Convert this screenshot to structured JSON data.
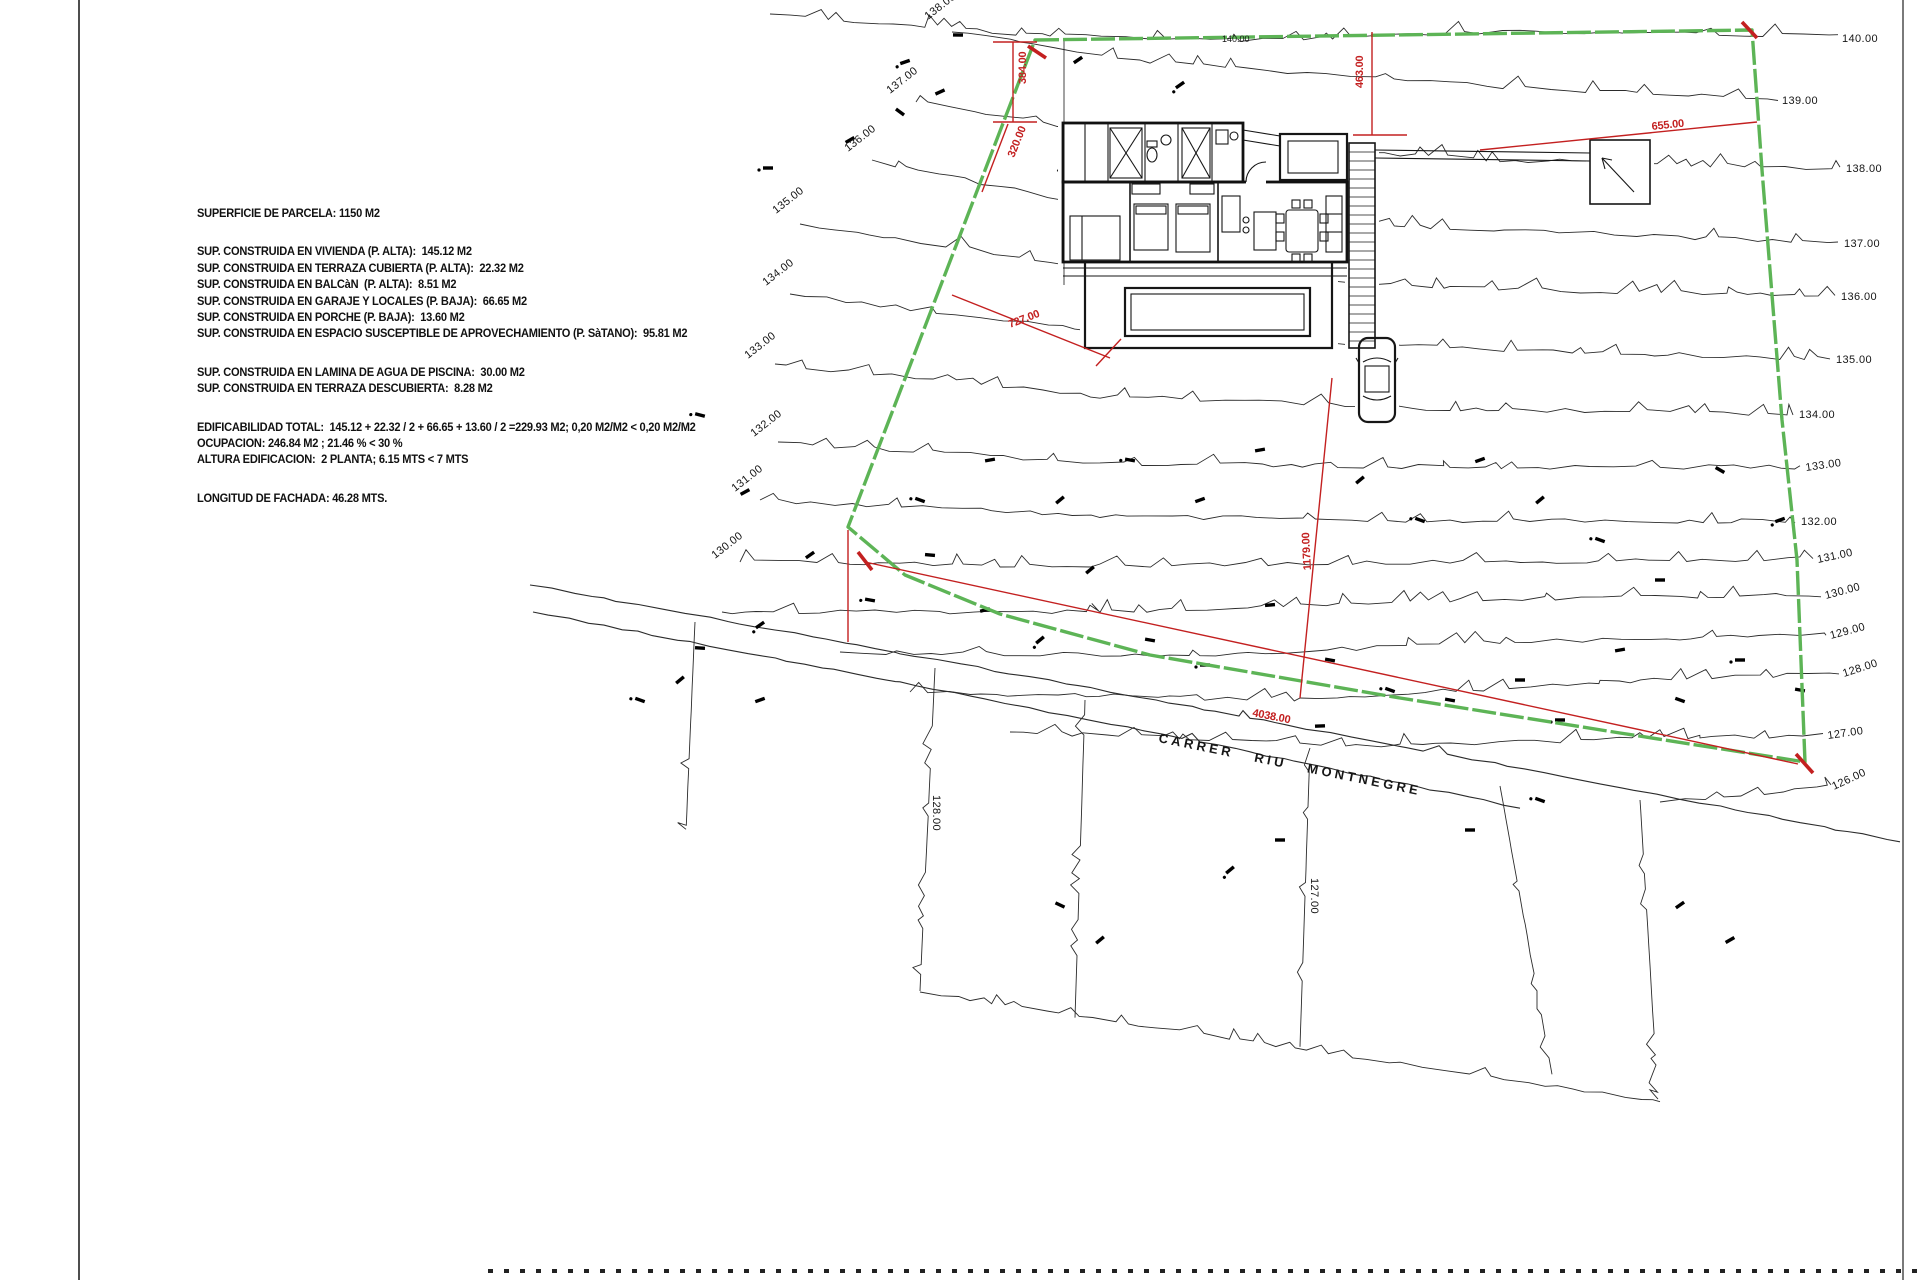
{
  "sheet": {
    "width": 1920,
    "height": 1280
  },
  "colors": {
    "line": "#2b2b2b",
    "boundary_green": "#5db456",
    "dim_red": "#c32020",
    "text": "#111111"
  },
  "info_panel": {
    "x": 197,
    "y": 206,
    "lines": [
      "SUPERFICIE DE PARCELA: 1150 M2",
      "",
      "",
      "SUP. CONSTRUIDA EN VIVIENDA (P. ALTA):  145.12 M2",
      "SUP. CONSTRUIDA EN TERRAZA CUBIERTA (P. ALTA):  22.32 M2",
      "SUP. CONSTRUIDA EN BALCàN  (P. ALTA):  8.51 M2",
      "SUP. CONSTRUIDA EN GARAJE Y LOCALES (P. BAJA):  66.65 M2",
      "SUP. CONSTRUIDA EN PORCHE (P. BAJA):  13.60 M2",
      "SUP. CONSTRUIDA EN ESPACIO SUSCEPTIBLE DE APROVECHAMIENTO (P. SàTANO):  95.81 M2",
      "",
      "",
      "SUP. CONSTRUIDA EN LAMINA DE AGUA DE PISCINA:  30.00 M2",
      "SUP. CONSTRUIDA EN TERRAZA DESCUBIERTA:  8.28 M2",
      "",
      "",
      "EDIFICABILIDAD TOTAL:  145.12 + 22.32 / 2 + 66.65 + 13.60 / 2 =229.93 M2; 0,20 M2/M2 < 0,20 M2/M2",
      "OCUPACION: 246.84 M2 ; 21.46 % < 30 %",
      "ALTURA EDIFICACION:  2 PLANTA; 6.15 MTS < 7 MTS",
      "",
      "",
      "LONGITUD DE FACHADA: 46.28 MTS."
    ]
  },
  "street": {
    "name": "CARRER  RIU  MONTNEGRE",
    "x": 1158,
    "y": 742,
    "rotate": 11.5
  },
  "site": {
    "boundary": [
      [
        1035,
        40
      ],
      [
        1752,
        30
      ],
      [
        1762,
        170
      ],
      [
        1782,
        420
      ],
      [
        1797,
        560
      ],
      [
        1805,
        762
      ],
      [
        1620,
        733
      ],
      [
        1400,
        698
      ],
      [
        1150,
        655
      ],
      [
        1000,
        614
      ],
      [
        905,
        575
      ],
      [
        848,
        527
      ]
    ],
    "contours": [
      {
        "e": 140,
        "pts": [
          [
            770,
            14
          ],
          [
            1050,
            36
          ],
          [
            1240,
            40
          ],
          [
            1520,
            32
          ],
          [
            1838,
            36
          ]
        ]
      },
      {
        "e": 139,
        "pts": [
          [
            952,
            32
          ],
          [
            1150,
            62
          ],
          [
            1450,
            84
          ],
          [
            1778,
            100
          ]
        ]
      },
      {
        "e": 138,
        "pts": [
          [
            916,
            102
          ],
          [
            1150,
            140
          ],
          [
            1500,
            160
          ],
          [
            1840,
            168
          ]
        ]
      },
      {
        "e": 137,
        "pts": [
          [
            872,
            160
          ],
          [
            1100,
            208
          ],
          [
            1450,
            228
          ],
          [
            1838,
            243
          ]
        ]
      },
      {
        "e": 136,
        "pts": [
          [
            800,
            224
          ],
          [
            1100,
            268
          ],
          [
            1450,
            288
          ],
          [
            1835,
            296
          ]
        ]
      },
      {
        "e": 135,
        "pts": [
          [
            790,
            294
          ],
          [
            1100,
            332
          ],
          [
            1450,
            348
          ],
          [
            1830,
            359
          ]
        ]
      },
      {
        "e": 134,
        "pts": [
          [
            775,
            364
          ],
          [
            1100,
            396
          ],
          [
            1450,
            409
          ],
          [
            1793,
            414
          ]
        ]
      },
      {
        "e": 133,
        "pts": [
          [
            778,
            442
          ],
          [
            1100,
            463
          ],
          [
            1450,
            467
          ],
          [
            1800,
            467
          ]
        ]
      },
      {
        "e": 132,
        "pts": [
          [
            760,
            500
          ],
          [
            1100,
            516
          ],
          [
            1450,
            521
          ],
          [
            1795,
            521
          ]
        ]
      },
      {
        "e": 131,
        "pts": [
          [
            740,
            562
          ],
          [
            1100,
            566
          ],
          [
            1450,
            562
          ],
          [
            1813,
            559
          ]
        ]
      },
      {
        "e": 130,
        "pts": [
          [
            722,
            612
          ],
          [
            1100,
            612
          ],
          [
            1450,
            600
          ],
          [
            1821,
            595
          ]
        ]
      },
      {
        "e": 129,
        "pts": [
          [
            840,
            652
          ],
          [
            1200,
            656
          ],
          [
            1500,
            642
          ],
          [
            1826,
            635
          ]
        ]
      },
      {
        "e": 128,
        "pts": [
          [
            910,
            692
          ],
          [
            1300,
            700
          ],
          [
            1600,
            682
          ],
          [
            1839,
            673
          ]
        ]
      },
      {
        "e": 127,
        "pts": [
          [
            1010,
            732
          ],
          [
            1400,
            746
          ],
          [
            1700,
            737
          ],
          [
            1823,
            735
          ]
        ]
      },
      {
        "e": 126,
        "pts": [
          [
            1660,
            802
          ],
          [
            1831,
            786
          ]
        ]
      }
    ],
    "contour_labels": {
      "right": [
        {
          "t": "140.00",
          "x": 1842,
          "y": 42,
          "r": 0
        },
        {
          "t": "139.00",
          "x": 1782,
          "y": 104,
          "r": 0
        },
        {
          "t": "138.00",
          "x": 1846,
          "y": 172,
          "r": 0
        },
        {
          "t": "137.00",
          "x": 1844,
          "y": 247,
          "r": 0
        },
        {
          "t": "136.00",
          "x": 1841,
          "y": 300,
          "r": 0
        },
        {
          "t": "135.00",
          "x": 1836,
          "y": 363,
          "r": 0
        },
        {
          "t": "134.00",
          "x": 1799,
          "y": 418,
          "r": 0
        },
        {
          "t": "133.00",
          "x": 1806,
          "y": 471,
          "r": -8
        },
        {
          "t": "132.00",
          "x": 1801,
          "y": 525,
          "r": 0
        },
        {
          "t": "131.00",
          "x": 1818,
          "y": 563,
          "r": -12
        },
        {
          "t": "130.00",
          "x": 1826,
          "y": 599,
          "r": -15
        },
        {
          "t": "129.00",
          "x": 1831,
          "y": 639,
          "r": -15
        },
        {
          "t": "128.00",
          "x": 1844,
          "y": 677,
          "r": -18
        },
        {
          "t": "127.00",
          "x": 1828,
          "y": 739,
          "r": -8
        },
        {
          "t": "126.00",
          "x": 1834,
          "y": 790,
          "r": -25
        }
      ],
      "left": [
        {
          "t": "138.00",
          "x": 928,
          "y": 20,
          "r": -38
        },
        {
          "t": "137.00",
          "x": 890,
          "y": 94,
          "r": -38
        },
        {
          "t": "136.00",
          "x": 848,
          "y": 152,
          "r": -38
        },
        {
          "t": "135.00",
          "x": 776,
          "y": 214,
          "r": -38
        },
        {
          "t": "134.00",
          "x": 766,
          "y": 286,
          "r": -38
        },
        {
          "t": "133.00",
          "x": 748,
          "y": 359,
          "r": -38
        },
        {
          "t": "132.00",
          "x": 754,
          "y": 437,
          "r": -38
        },
        {
          "t": "131.00",
          "x": 735,
          "y": 492,
          "r": -38
        },
        {
          "t": "130.00",
          "x": 715,
          "y": 559,
          "r": -38
        }
      ],
      "street_side": [
        {
          "t": "128.00",
          "x": 933,
          "y": 795,
          "r": 90
        },
        {
          "t": "127.00",
          "x": 1311,
          "y": 878,
          "r": 90
        }
      ],
      "online": [
        {
          "t": "140.00",
          "x": 1222,
          "y": 42,
          "r": 0
        }
      ]
    },
    "dim_labels": [
      {
        "t": "384.00",
        "x": 1026,
        "y": 84,
        "r": -90
      },
      {
        "t": "320.00",
        "x": 1014,
        "y": 158,
        "r": -68
      },
      {
        "t": "463.00",
        "x": 1363,
        "y": 88,
        "r": -90
      },
      {
        "t": "655.00",
        "x": 1652,
        "y": 130,
        "r": -6
      },
      {
        "t": "727.00",
        "x": 1010,
        "y": 328,
        "r": -21
      },
      {
        "t": "1179.00",
        "x": 1311,
        "y": 570,
        "r": -93
      },
      {
        "t": "4038.00",
        "x": 1252,
        "y": 716,
        "r": 11
      }
    ],
    "dim_lines": [
      [
        1013,
        42,
        1013,
        122
      ],
      [
        993,
        42,
        1037,
        42
      ],
      [
        993,
        122,
        1037,
        122
      ],
      [
        1008,
        124,
        982,
        192
      ],
      [
        1372,
        32,
        1372,
        135
      ],
      [
        1353,
        135,
        1407,
        135
      ],
      [
        1480,
        150,
        1757,
        122
      ],
      [
        952,
        295,
        1110,
        358
      ],
      [
        1096,
        366,
        1121,
        339
      ],
      [
        1332,
        378,
        1300,
        698
      ],
      [
        865,
        562,
        1798,
        764
      ],
      [
        848,
        530,
        848,
        642
      ]
    ],
    "corner_ticks": [
      [
        1028,
        46,
        1046,
        58
      ],
      [
        1742,
        22,
        1757,
        38
      ],
      [
        1796,
        754,
        1813,
        773
      ],
      [
        858,
        552,
        872,
        570
      ]
    ],
    "street_lines": [
      [
        [
          530,
          585
        ],
        [
          900,
          653
        ],
        [
          1250,
          718
        ],
        [
          1600,
          783
        ],
        [
          1900,
          842
        ]
      ],
      [
        [
          533,
          612
        ],
        [
          900,
          682
        ],
        [
          1250,
          752
        ],
        [
          1520,
          808
        ]
      ]
    ],
    "parcel_lines": [
      [
        [
          935,
          668
        ],
        [
          920,
          990
        ]
      ],
      [
        [
          1085,
          700
        ],
        [
          1075,
          1018
        ]
      ],
      [
        [
          1310,
          748
        ],
        [
          1300,
          1046
        ]
      ],
      [
        [
          1500,
          786
        ],
        [
          1552,
          1074
        ]
      ],
      [
        [
          1640,
          800
        ],
        [
          1658,
          1100
        ]
      ],
      [
        [
          920,
          992
        ],
        [
          1240,
          1040
        ],
        [
          1660,
          1102
        ]
      ],
      [
        [
          695,
          622
        ],
        [
          686,
          830
        ]
      ]
    ],
    "louver": {
      "x": 1349,
      "y": 143,
      "w": 26,
      "h": 205,
      "step": 9
    },
    "vegetation": [
      [
        905,
        62
      ],
      [
        940,
        92
      ],
      [
        1078,
        60
      ],
      [
        1180,
        85
      ],
      [
        958,
        35
      ],
      [
        900,
        112
      ],
      [
        768,
        168
      ],
      [
        850,
        140
      ],
      [
        1062,
        172
      ],
      [
        700,
        415
      ],
      [
        745,
        492
      ],
      [
        810,
        555
      ],
      [
        870,
        600
      ],
      [
        930,
        555
      ],
      [
        985,
        610
      ],
      [
        1040,
        640
      ],
      [
        1090,
        570
      ],
      [
        1150,
        640
      ],
      [
        1205,
        665
      ],
      [
        1270,
        605
      ],
      [
        1330,
        660
      ],
      [
        1390,
        690
      ],
      [
        1450,
        700
      ],
      [
        1520,
        680
      ],
      [
        1560,
        720
      ],
      [
        1620,
        650
      ],
      [
        1680,
        700
      ],
      [
        1740,
        660
      ],
      [
        1800,
        690
      ],
      [
        680,
        680
      ],
      [
        640,
        700
      ],
      [
        760,
        700
      ],
      [
        1360,
        480
      ],
      [
        1420,
        520
      ],
      [
        1480,
        460
      ],
      [
        1540,
        500
      ],
      [
        1600,
        540
      ],
      [
        1660,
        580
      ],
      [
        1720,
        470
      ],
      [
        1780,
        520
      ],
      [
        1260,
        450
      ],
      [
        1200,
        500
      ],
      [
        1130,
        460
      ],
      [
        1060,
        500
      ],
      [
        990,
        460
      ],
      [
        920,
        500
      ],
      [
        1680,
        905
      ],
      [
        1730,
        940
      ],
      [
        1540,
        800
      ],
      [
        1470,
        830
      ],
      [
        1280,
        840
      ],
      [
        1230,
        870
      ],
      [
        1100,
        940
      ],
      [
        1060,
        905
      ],
      [
        760,
        625
      ],
      [
        700,
        648
      ],
      [
        1320,
        726
      ]
    ],
    "frame": {
      "left_x": 79,
      "right_x": 1903,
      "bottom_y": 1271,
      "bottom_start_x": 488
    }
  }
}
